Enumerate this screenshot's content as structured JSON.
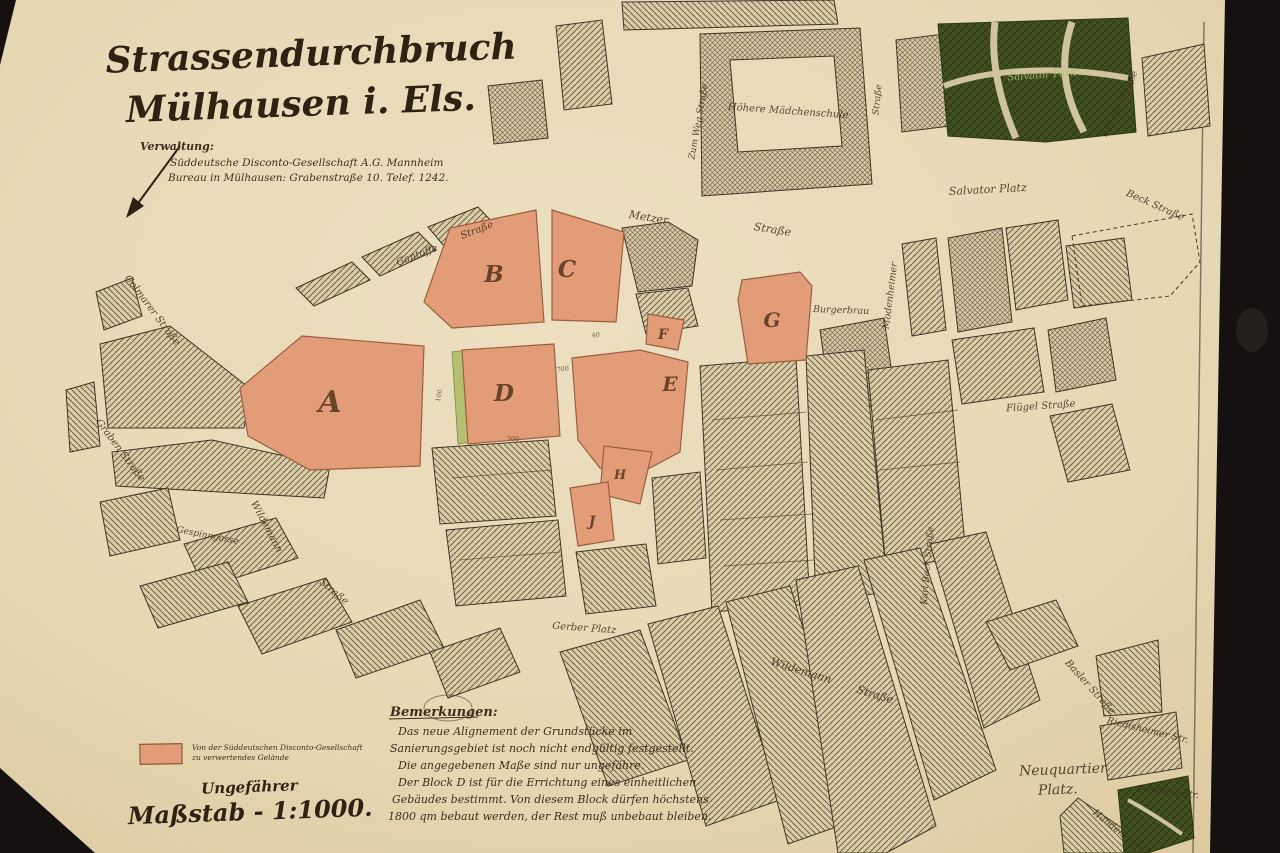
{
  "title": {
    "line1": "Strassendurchbruch",
    "line2": "Mülhausen i. Els."
  },
  "administration": {
    "heading": "Verwaltung:",
    "line1": "Süddeutsche Disconto-Gesellschaft A.G. Mannheim",
    "line2": "Bureau in Mülhausen: Grabenstraße 10. Telef. 1242."
  },
  "legend": {
    "line1": "Von der Süddeutschen Disconto-Gesellschaft",
    "line2": "zu verwertendes Gelände",
    "swatch_color": "#e29d78"
  },
  "scale": {
    "line1": "Ungefährer",
    "line2": "Maßstab - 1:1000."
  },
  "remarks": {
    "heading": "Bemerkungen:",
    "lines": [
      "Das neue Alignement der Grundstücke im",
      "Sanierungsgebiet ist noch nicht endgültig festgestellt.",
      "Die angegebenen Maße sind nur ungefähre.",
      "Der Block D ist für die Errichtung eines einheitlichen",
      "Gebäudes bestimmt. Von diesem Block dürfen höchstens",
      "1800 qm bebaut werden, der Rest muß unbebaut bleiben."
    ]
  },
  "map": {
    "colors": {
      "paper": "#e7d8b4",
      "ink": "#3c2f1c",
      "block_fill": "#e29d78",
      "block_stroke": "#9a5f40",
      "park_green": "#3e4c1e",
      "strip_green": "#b5bf72",
      "hatch": "#5f5341"
    },
    "blocks": [
      {
        "letter": "A",
        "x": 330,
        "y": 412,
        "size": 30
      },
      {
        "letter": "B",
        "x": 494,
        "y": 282,
        "size": 23
      },
      {
        "letter": "C",
        "x": 567,
        "y": 277,
        "size": 23
      },
      {
        "letter": "D",
        "x": 504,
        "y": 401,
        "size": 23
      },
      {
        "letter": "E",
        "x": 670,
        "y": 391,
        "size": 20
      },
      {
        "letter": "F",
        "x": 663,
        "y": 339,
        "size": 14
      },
      {
        "letter": "G",
        "x": 772,
        "y": 327,
        "size": 20
      },
      {
        "letter": "H",
        "x": 620,
        "y": 479,
        "size": 13
      },
      {
        "letter": "J",
        "x": 592,
        "y": 526,
        "size": 14
      }
    ],
    "street_labels": [
      {
        "text": "Gantoffe",
        "x": 418,
        "y": 258,
        "rot": -21,
        "size": 10
      },
      {
        "text": "Straße",
        "x": 478,
        "y": 233,
        "rot": -21,
        "size": 10
      },
      {
        "text": "Metzer",
        "x": 648,
        "y": 221,
        "rot": 9,
        "size": 11
      },
      {
        "text": "Straße",
        "x": 772,
        "y": 233,
        "rot": 9,
        "size": 11
      },
      {
        "text": "Colmarer Straße",
        "x": 150,
        "y": 312,
        "rot": 53,
        "size": 10
      },
      {
        "text": "Graben Straße",
        "x": 118,
        "y": 452,
        "rot": 53,
        "size": 10
      },
      {
        "text": "Wildemann",
        "x": 264,
        "y": 528,
        "rot": 62,
        "size": 10
      },
      {
        "text": "Straße",
        "x": 332,
        "y": 594,
        "rot": 40,
        "size": 10
      },
      {
        "text": "Gespinngasse",
        "x": 207,
        "y": 538,
        "rot": 11,
        "size": 9
      },
      {
        "text": "Wildemann",
        "x": 800,
        "y": 674,
        "rot": 17,
        "size": 11
      },
      {
        "text": "Straße",
        "x": 874,
        "y": 698,
        "rot": 17,
        "size": 11
      },
      {
        "text": "Gerber Platz",
        "x": 584,
        "y": 631,
        "rot": 4,
        "size": 10
      },
      {
        "text": "Höhere Mädchenschule",
        "x": 788,
        "y": 114,
        "rot": 4,
        "size": 10
      },
      {
        "text": "Zum Weg Straße",
        "x": 701,
        "y": 122,
        "rot": -80,
        "size": 9
      },
      {
        "text": "Straße",
        "x": 880,
        "y": 100,
        "rot": -84,
        "size": 9
      },
      {
        "text": "Salvator Platz",
        "x": 988,
        "y": 193,
        "rot": -3,
        "size": 11
      },
      {
        "text": "Salvator Straße",
        "x": 1122,
        "y": 105,
        "rot": -64,
        "size": 9
      },
      {
        "text": "Beck Straße",
        "x": 1154,
        "y": 208,
        "rot": 24,
        "size": 10
      },
      {
        "text": "Modenheimer",
        "x": 893,
        "y": 296,
        "rot": -83,
        "size": 9.5
      },
      {
        "text": "Burgerbrau",
        "x": 841,
        "y": 313,
        "rot": 2,
        "size": 9.5
      },
      {
        "text": "Karl Bock Straße",
        "x": 930,
        "y": 566,
        "rot": -85,
        "size": 9
      },
      {
        "text": "Flügel Straße",
        "x": 1041,
        "y": 409,
        "rot": -4,
        "size": 10
      },
      {
        "text": "Basler Straße",
        "x": 1088,
        "y": 689,
        "rot": 48,
        "size": 10
      },
      {
        "text": "Riedisheimer Str.",
        "x": 1147,
        "y": 733,
        "rot": 14,
        "size": 9.5
      },
      {
        "text": "Friedens Str.",
        "x": 1168,
        "y": 795,
        "rot": 6,
        "size": 9.5
      },
      {
        "text": "Handels-Straße",
        "x": 1122,
        "y": 837,
        "rot": 38,
        "size": 9.5
      }
    ],
    "park_label": {
      "text": "Salvator Park",
      "x": 1042,
      "y": 78,
      "rot": -4,
      "size": 10
    },
    "place_labels": [
      {
        "text": "Neuquartier",
        "x": 1063,
        "y": 774,
        "rot": -2,
        "size": 14
      },
      {
        "text": "Platz.",
        "x": 1058,
        "y": 794,
        "rot": -2,
        "size": 14
      }
    ],
    "numbers": [
      {
        "text": "700",
        "x": 563,
        "y": 371,
        "rot": -8
      },
      {
        "text": "100",
        "x": 441,
        "y": 396,
        "rot": -78
      },
      {
        "text": "700",
        "x": 513,
        "y": 441,
        "rot": 2
      },
      {
        "text": "40",
        "x": 596,
        "y": 337,
        "rot": -8
      }
    ]
  }
}
